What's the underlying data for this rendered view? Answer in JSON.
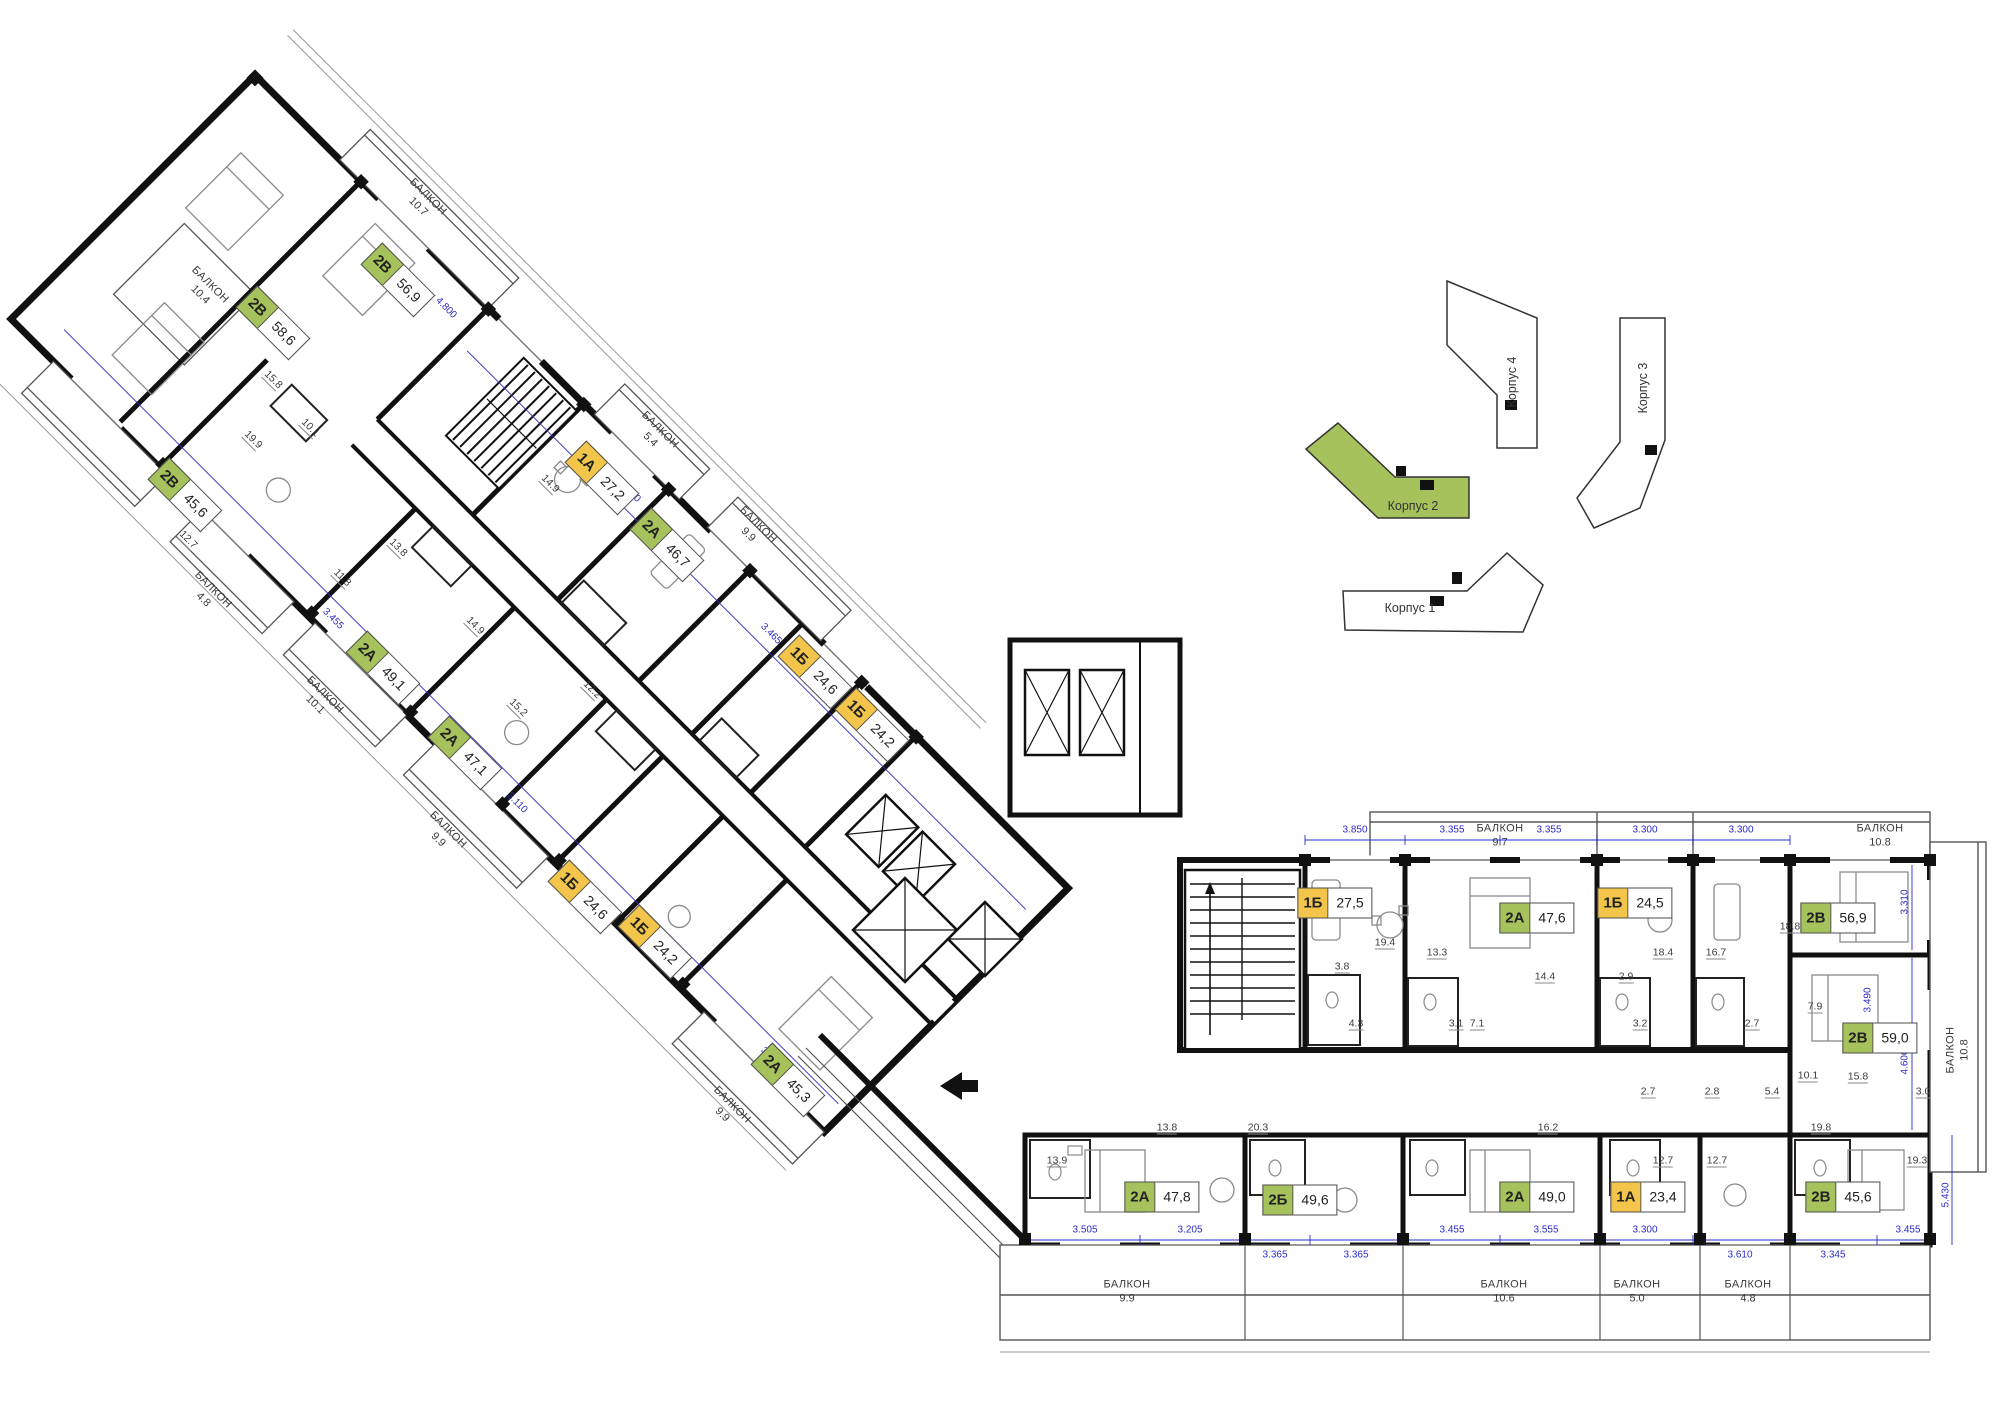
{
  "plan": {
    "wall_color": "#111111",
    "accent_green": "#a6c25c",
    "accent_yellow": "#f3c64b",
    "dim_color": "#2b2bcc",
    "units": [
      {
        "type": "2В",
        "area": "58,6",
        "style": "green",
        "wing": "left"
      },
      {
        "type": "2В",
        "area": "56,9",
        "style": "green",
        "wing": "left"
      },
      {
        "type": "2В",
        "area": "45,6",
        "style": "green",
        "wing": "left"
      },
      {
        "type": "1А",
        "area": "27,2",
        "style": "yellow",
        "wing": "left"
      },
      {
        "type": "2А",
        "area": "46,7",
        "style": "green",
        "wing": "left"
      },
      {
        "type": "1Б",
        "area": "24,6",
        "style": "yellow",
        "wing": "left"
      },
      {
        "type": "1Б",
        "area": "24,2",
        "style": "yellow",
        "wing": "left"
      },
      {
        "type": "2А",
        "area": "49,1",
        "style": "green",
        "wing": "left"
      },
      {
        "type": "2А",
        "area": "47,1",
        "style": "green",
        "wing": "left"
      },
      {
        "type": "1Б",
        "area": "24,6",
        "style": "yellow",
        "wing": "left"
      },
      {
        "type": "1Б",
        "area": "24,2",
        "style": "yellow",
        "wing": "left"
      },
      {
        "type": "2А",
        "area": "45,3",
        "style": "green",
        "wing": "left"
      },
      {
        "type": "1Б",
        "area": "27,5",
        "style": "yellow",
        "wing": "right"
      },
      {
        "type": "2А",
        "area": "47,6",
        "style": "green",
        "wing": "right"
      },
      {
        "type": "1Б",
        "area": "24,5",
        "style": "yellow",
        "wing": "right"
      },
      {
        "type": "2В",
        "area": "56,9",
        "style": "green",
        "wing": "right"
      },
      {
        "type": "2В",
        "area": "59,0",
        "style": "green",
        "wing": "right"
      },
      {
        "type": "2А",
        "area": "47,8",
        "style": "green",
        "wing": "right"
      },
      {
        "type": "2Б",
        "area": "49,6",
        "style": "green",
        "wing": "right"
      },
      {
        "type": "2А",
        "area": "49,0",
        "style": "green",
        "wing": "right"
      },
      {
        "type": "1А",
        "area": "23,4",
        "style": "yellow",
        "wing": "right"
      },
      {
        "type": "2В",
        "area": "45,6",
        "style": "green",
        "wing": "right"
      }
    ],
    "balconies": [
      {
        "label": "БАЛКОН",
        "value": "10.4"
      },
      {
        "label": "БАЛКОН",
        "value": "10.7"
      },
      {
        "label": "БАЛКОН",
        "value": "5.4"
      },
      {
        "label": "БАЛКОН",
        "value": "9.9"
      },
      {
        "label": "БАЛКОН",
        "value": "4.8"
      },
      {
        "label": "БАЛКОН",
        "value": "10.1"
      },
      {
        "label": "БАЛКОН",
        "value": "9.9"
      },
      {
        "label": "БАЛКОН",
        "value": "9.9"
      },
      {
        "label": "БАЛКОН",
        "value": "9.7"
      },
      {
        "label": "БАЛКОН",
        "value": "10.8"
      },
      {
        "label": "БАЛКОН",
        "value": "10.8"
      },
      {
        "label": "БАЛКОН",
        "value": "9.9"
      },
      {
        "label": "БАЛКОН",
        "value": "10.6"
      },
      {
        "label": "БАЛКОН",
        "value": "5.0"
      },
      {
        "label": "БАЛКОН",
        "value": "4.8"
      }
    ],
    "room_areas": [
      "19.4",
      "13.3",
      "3.8",
      "4.3",
      "14.4",
      "3.1",
      "7.1",
      "18.4",
      "16.7",
      "2.9",
      "3.2",
      "2.7",
      "18.8",
      "7.9",
      "10.1",
      "15.8",
      "19.8",
      "19.3",
      "13.9",
      "13.8",
      "20.3",
      "16.2",
      "12.7",
      "12.7",
      "5.4",
      "3.0",
      "2.8",
      "2.7",
      "15.8",
      "19.9",
      "10.1",
      "12.7",
      "11.8",
      "14.9",
      "13.8",
      "15.2",
      "14.9",
      "12.2"
    ],
    "dims": [
      "3.850",
      "3.355",
      "3.355",
      "3.300",
      "3.300",
      "3.505",
      "3.205",
      "3.365",
      "3.365",
      "3.455",
      "3.555",
      "3.300",
      "3.610",
      "3.345",
      "3.455",
      "3.310",
      "4.600",
      "5.430",
      "3.490",
      "3.310",
      "4.800",
      "3.465",
      "3.110",
      "3.390",
      "3.300",
      "3.455"
    ]
  },
  "site_map": {
    "selected": "Корпус 2",
    "buildings": [
      {
        "name": "Корпус 1",
        "selected": false
      },
      {
        "name": "Корпус 2",
        "selected": true
      },
      {
        "name": "Корпус 3",
        "selected": false
      },
      {
        "name": "Корпус 4",
        "selected": false
      }
    ]
  }
}
